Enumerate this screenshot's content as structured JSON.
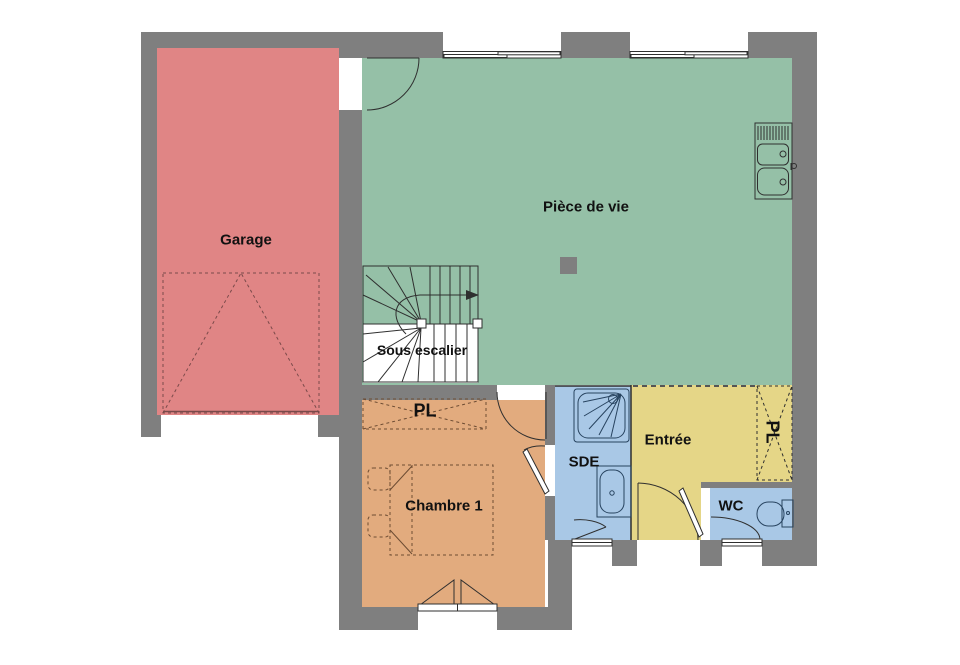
{
  "floorplan": {
    "labels": {
      "garage": "Garage",
      "living_room": "Pièce de vie",
      "under_stairs": "Sous escalier",
      "bedroom_closet": "PL",
      "bedroom": "Chambre 1",
      "shower_room": "SDE",
      "entrance": "Entrée",
      "entrance_closet": "PL",
      "toilet": "WC"
    },
    "colors": {
      "wall": "#7f7f7f",
      "garage": "#e08585",
      "living_room": "#95c0a7",
      "bedroom": "#e2ab7e",
      "shower_room": "#a9c8e6",
      "entrance": "#e5d687",
      "toilet": "#a9c8e6",
      "background": "#ffffff",
      "line": "#2f2f2f"
    }
  }
}
